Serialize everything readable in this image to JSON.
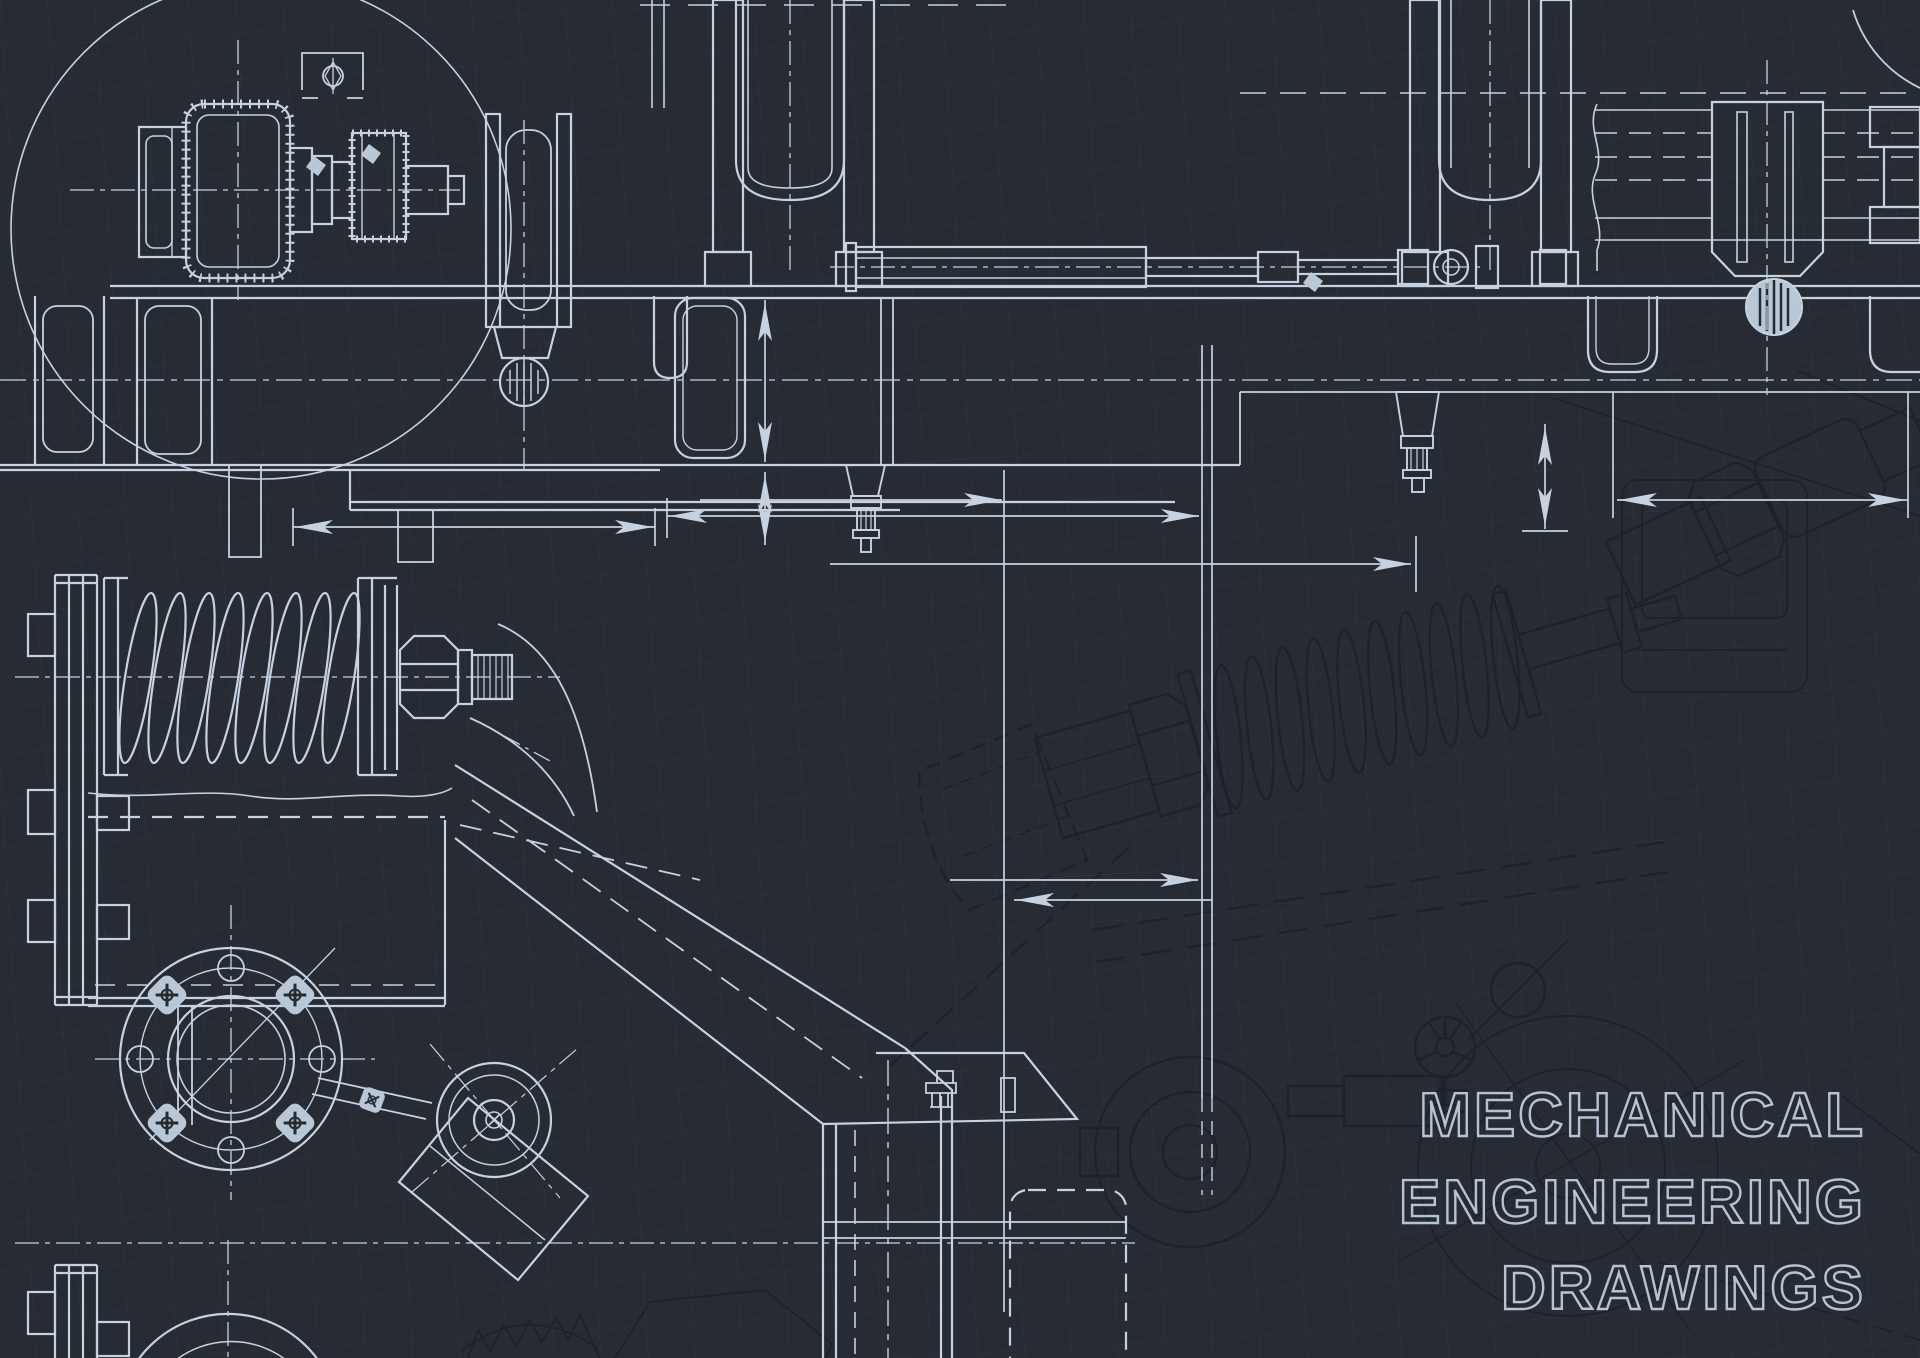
{
  "canvas": {
    "width": 1920,
    "height": 1358,
    "background": "#272b34"
  },
  "palette": {
    "foreground_line": "#c6d2e0",
    "foreground_fill": "#b9c7d6",
    "background_line": "#1d212a",
    "grid_line": "#3a4150",
    "text_outline": "#b6c3d3"
  },
  "title": {
    "line1": "MECHANICAL",
    "line2": "ENGINEERING",
    "line3": "DRAWINGS"
  }
}
